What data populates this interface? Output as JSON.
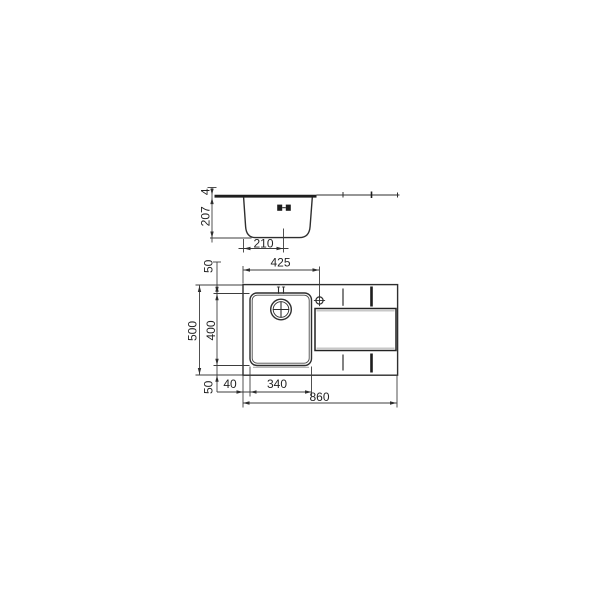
{
  "drawing": {
    "description": "Dimensioned technical drawing of an inset kitchen sink with single bowl and drainer: side section view above, plan view below",
    "colors": {
      "line": "#2e2e2e",
      "thick_line": "#1d1d1d",
      "dim_line": "#3d3d3d",
      "shadow": "#b5b5b5",
      "text": "#232323",
      "background": "#ffffff"
    },
    "icons": {
      "drain_outlet": "drain-outlet-icon",
      "waste_drain": "waste-drain-icon",
      "tap_hole": "tap-hole-icon",
      "overflow": "overflow-marks-icon"
    },
    "section_view": {
      "labels": {
        "depth": "207",
        "rim_thickness": "4",
        "drain_offset": "210"
      }
    },
    "plan_view": {
      "labels": {
        "tap_centre_offset": "425",
        "rear_margin": "50",
        "overall_depth": "500",
        "bowl_depth": "400",
        "front_margin": "50",
        "side_margin": "40",
        "bowl_width": "340",
        "overall_width": "860"
      }
    }
  }
}
